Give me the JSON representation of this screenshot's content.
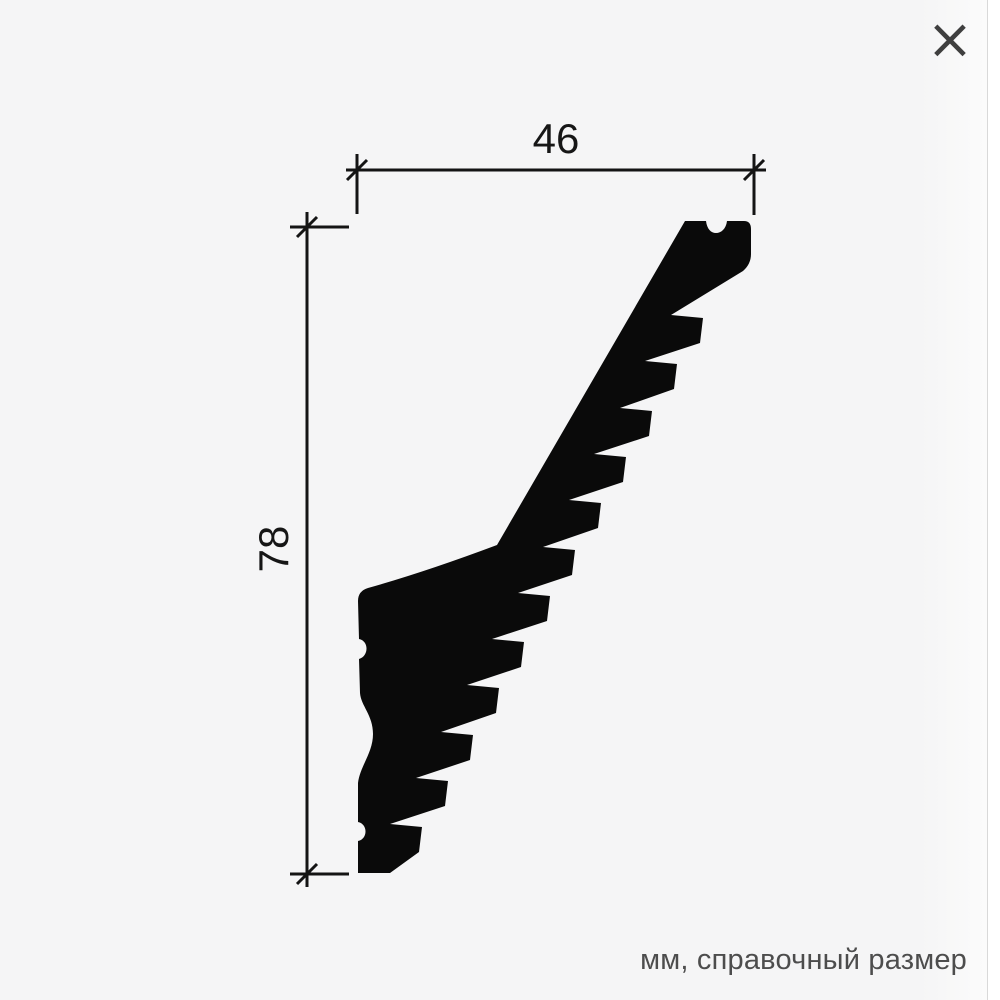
{
  "viewer": {
    "close_icon": "×"
  },
  "drawing": {
    "title": "molding profile cross-section",
    "width_mm": "46",
    "height_mm": "78",
    "unit_note": "мм, справочный размер"
  },
  "colors": {
    "background": "#f5f5f6",
    "edge_strip": "#ffffff",
    "drawing_lines": "#141414",
    "silhouette_fill": "#0a0a0a",
    "note_text": "#4d4d4d",
    "close_icon": "#3f3f3f"
  }
}
